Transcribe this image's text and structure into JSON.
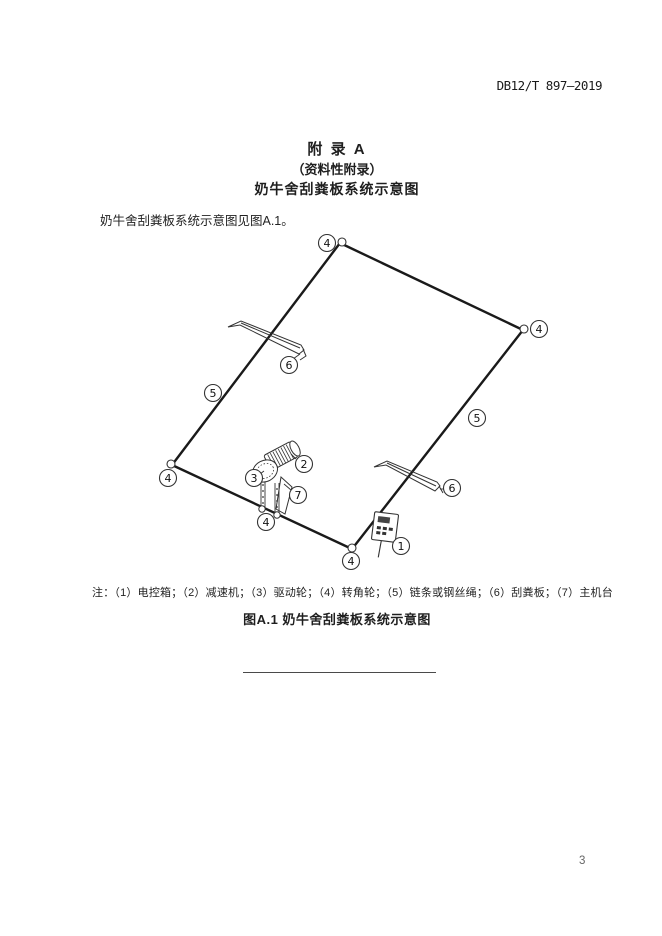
{
  "page": {
    "doc_number": "DB12/T 897—2019",
    "number": "3"
  },
  "appendix": {
    "title": "附  录  A",
    "subtitle": "（资料性附录）",
    "heading": "奶牛舍刮粪板系统示意图",
    "intro": "奶牛舍刮粪板系统示意图见图A.1。"
  },
  "figure": {
    "note": "注：（1）电控箱；（2）减速机；（3）驱动轮；（4）转角轮；（5）链条或钢丝绳；（6）刮粪板；（7）主机台",
    "caption": "图A.1  奶牛舍刮粪板系统示意图",
    "callouts": {
      "n1": "1",
      "n2": "2",
      "n3": "3",
      "n4": "4",
      "n5": "5",
      "n6": "6",
      "n7": "7"
    },
    "legend": [
      {
        "num": "1",
        "label": "电控箱"
      },
      {
        "num": "2",
        "label": "减速机"
      },
      {
        "num": "3",
        "label": "驱动轮"
      },
      {
        "num": "4",
        "label": "转角轮"
      },
      {
        "num": "5",
        "label": "链条或钢丝绳"
      },
      {
        "num": "6",
        "label": "刮粪板"
      },
      {
        "num": "7",
        "label": "主机台"
      }
    ],
    "colors": {
      "line": "#1a1a1a",
      "equipment": "#333333"
    }
  }
}
